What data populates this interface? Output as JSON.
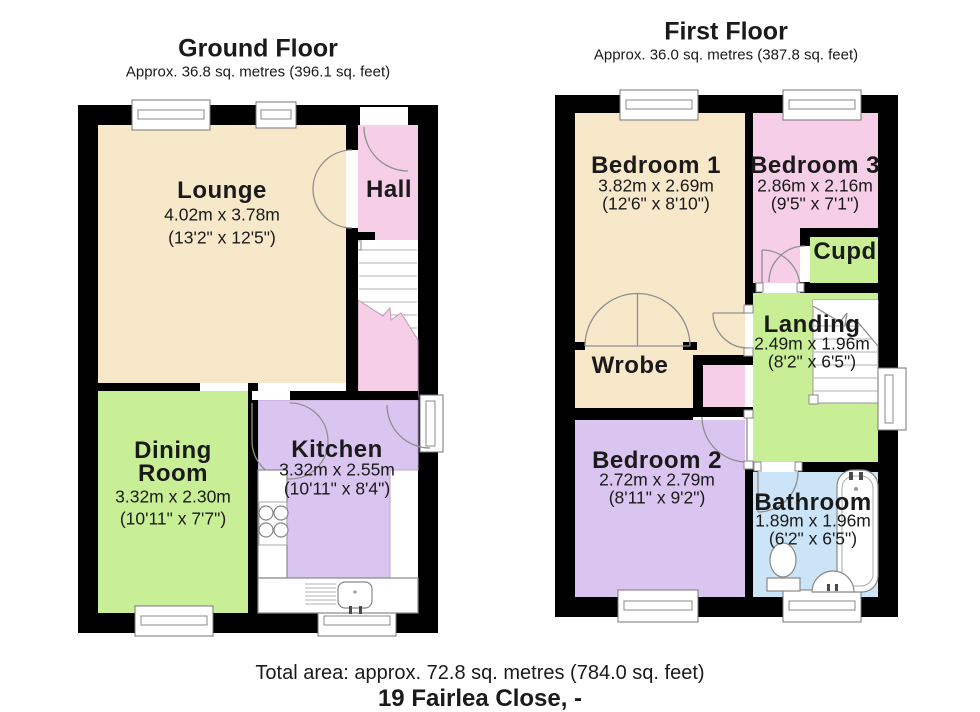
{
  "ground_floor": {
    "title": "Ground Floor",
    "subtitle": "Approx. 36.8 sq. metres (396.1 sq. feet)",
    "rooms": {
      "lounge": {
        "name": "Lounge",
        "metric": "4.02m x 3.78m",
        "imperial": "(13'2\" x 12'5\")"
      },
      "hall": {
        "name": "Hall"
      },
      "dining": {
        "name_line1": "Dining",
        "name_line2": "Room",
        "metric": "3.32m x 2.30m",
        "imperial": "(10'11\" x 7'7\")"
      },
      "kitchen": {
        "name": "Kitchen",
        "metric": "3.32m x 2.55m",
        "imperial": "(10'11\" x 8'4\")"
      }
    }
  },
  "first_floor": {
    "title": "First Floor",
    "subtitle": "Approx. 36.0 sq. metres (387.8 sq. feet)",
    "rooms": {
      "bedroom1": {
        "name": "Bedroom 1",
        "metric": "3.82m x 2.69m",
        "imperial": "(12'6\" x 8'10\")"
      },
      "bedroom3": {
        "name": "Bedroom 3",
        "metric": "2.86m x 2.16m",
        "imperial": "(9'5\" x 7'1\")"
      },
      "cupd": {
        "name": "Cupd"
      },
      "landing": {
        "name": "Landing",
        "metric": "2.49m x 1.96m",
        "imperial": "(8'2\" x 6'5\")"
      },
      "wrobe": {
        "name": "Wrobe"
      },
      "bedroom2": {
        "name": "Bedroom 2",
        "metric": "2.72m x 2.79m",
        "imperial": "(8'11\" x 9'2\")"
      },
      "bathroom": {
        "name": "Bathroom",
        "metric": "1.89m x 1.96m",
        "imperial": "(6'2\" x 6'5\")"
      }
    }
  },
  "footer": {
    "total_area": "Total area: approx. 72.8 sq. metres (784.0 sq. feet)",
    "address": "19 Fairlea Close, -"
  },
  "colors": {
    "cream": "#F8E8CA",
    "pink": "#F6CEE7",
    "green": "#C8EF95",
    "purple": "#DAC4F0",
    "blue": "#CBE4F7",
    "wall": "#000000"
  }
}
